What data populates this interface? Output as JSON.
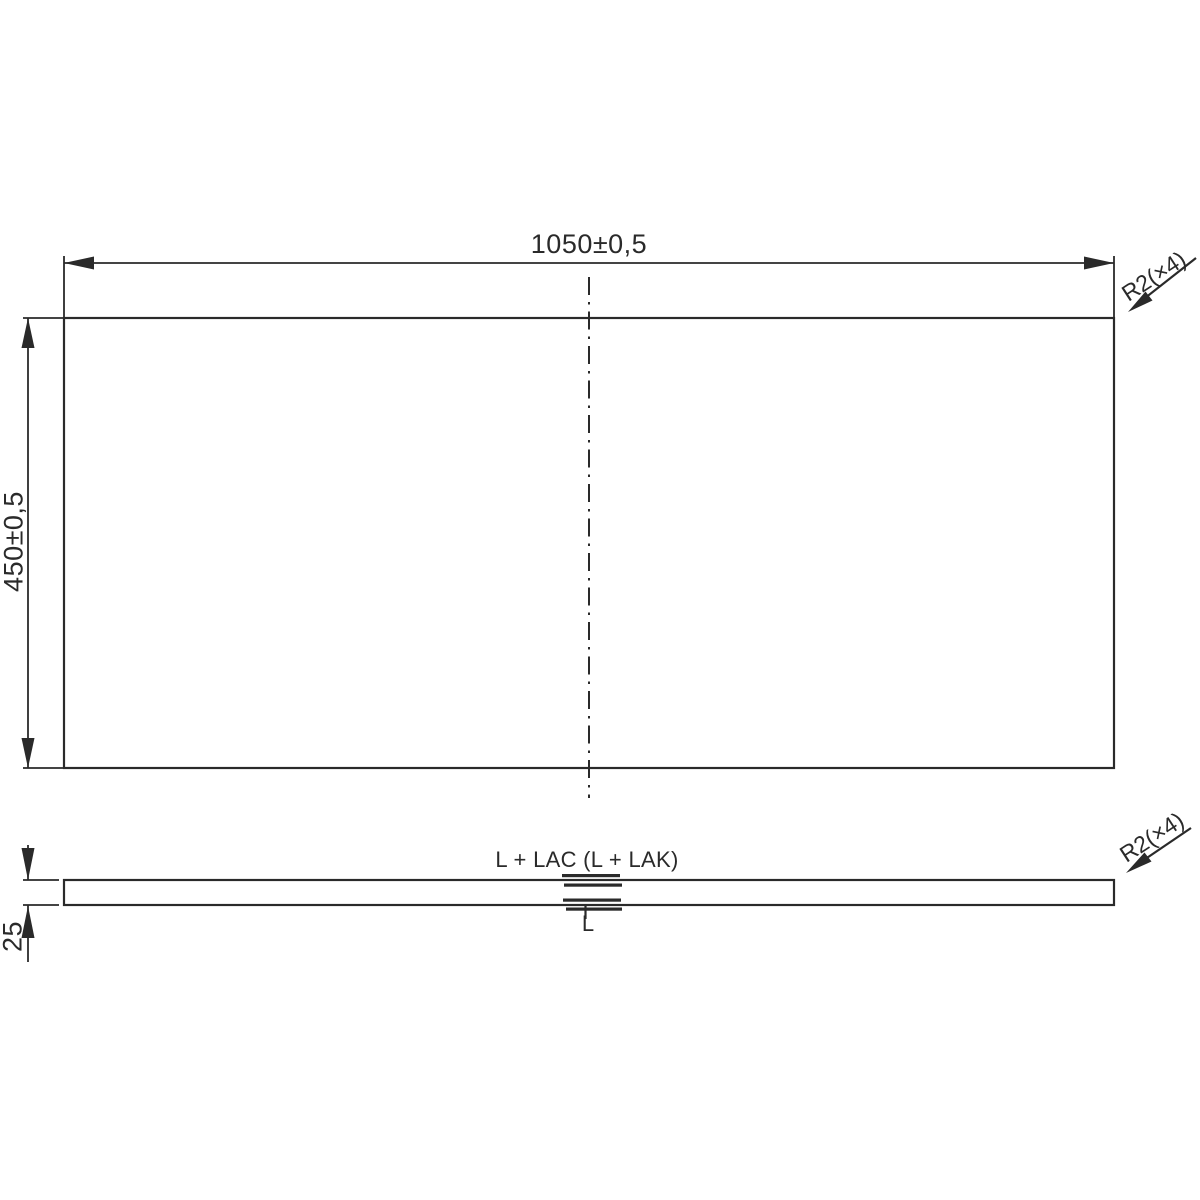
{
  "front_view": {
    "width_dim_label": "1050±0,5",
    "height_dim_label": "450±0,5",
    "radius_note": "R2(×4)"
  },
  "side_view": {
    "thickness_dim_label": "25",
    "radius_note": "R2(×4)",
    "top_surface_label": "L + LAC (L + LAK)",
    "bottom_surface_label": "L"
  },
  "colors": {
    "line": "#2a2a2a",
    "background": "#ffffff"
  }
}
